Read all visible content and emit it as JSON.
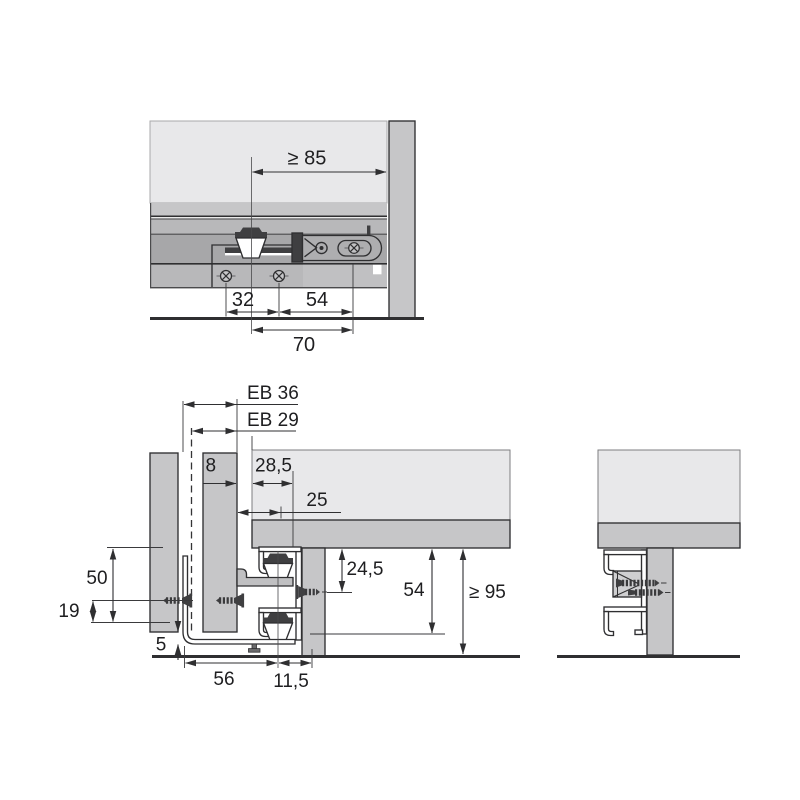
{
  "page": {
    "type": "technical-installation-drawing",
    "background": "#ffffff"
  },
  "colors": {
    "panel_light": "#e8e8ea",
    "panel_mid": "#c6c6c8",
    "strip_gray": "#b8b8ba",
    "rail_gray": "#a7a7a9",
    "plate_gray": "#aeaeb0",
    "outline_dark": "#2f2f31",
    "detail_dark": "#3f3f41",
    "text_dark": "#1e1e20",
    "white": "#ffffff"
  },
  "views": {
    "top": {
      "name": "drawer-slide-plan-view",
      "dims": {
        "min_side_space": "≥ 85",
        "screw_pitch": "32",
        "offset_54": "54",
        "offset_70": "70"
      }
    },
    "section": {
      "name": "front-cross-section",
      "dims": {
        "eb_36": "EB 36",
        "eb_29": "EB 29",
        "thickness_8": "8",
        "offset_28_5": "28,5",
        "offset_25": "25",
        "height_24_5": "24,5",
        "height_54": "54",
        "min_height_95": "≥ 95",
        "height_50": "50",
        "height_19": "19",
        "offset_5": "5",
        "width_56": "56",
        "width_11_5": "11,5"
      }
    },
    "side": {
      "name": "front-bracket-side-view"
    }
  }
}
